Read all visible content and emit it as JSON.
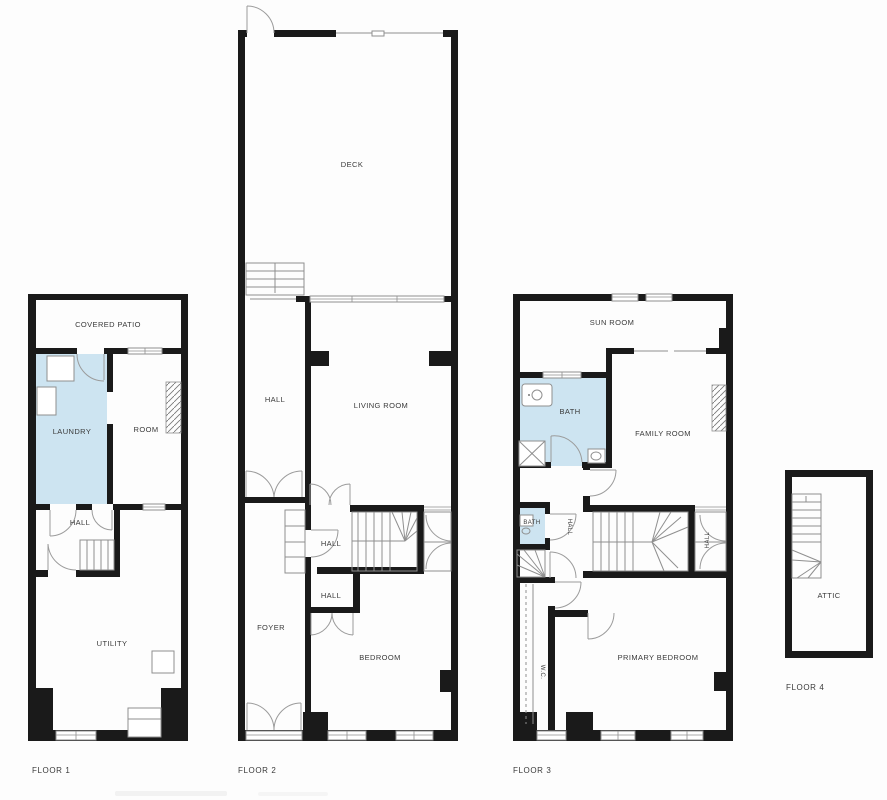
{
  "colors": {
    "wall": "#1a1a1a",
    "room-fill": "#cde4f1",
    "line": "#8f8f8f",
    "label": "#3a3a3a",
    "background": "#fdfdfd"
  },
  "floors": [
    {
      "label": "FLOOR 1",
      "rooms": {
        "covered_patio": "COVERED PATIO",
        "laundry": "LAUNDRY",
        "room": "ROOM",
        "hall": "HALL",
        "utility": "UTILITY"
      }
    },
    {
      "label": "FLOOR 2",
      "rooms": {
        "deck": "DECK",
        "hall_upper": "HALL",
        "living_room": "LIVING ROOM",
        "hall_stairs": "HALL",
        "hall_lower": "HALL",
        "foyer": "FOYER",
        "bedroom": "BEDROOM"
      }
    },
    {
      "label": "FLOOR 3",
      "rooms": {
        "sun_room": "SUN ROOM",
        "bath": "BATH",
        "family_room": "FAMILY ROOM",
        "bath_small": "BATH",
        "hall_left": "HALL",
        "hall_right": "HALL",
        "wc": "W.C.",
        "primary_bedroom": "PRIMARY BEDROOM"
      }
    },
    {
      "label": "FLOOR 4",
      "rooms": {
        "attic": "ATTIC"
      }
    }
  ]
}
